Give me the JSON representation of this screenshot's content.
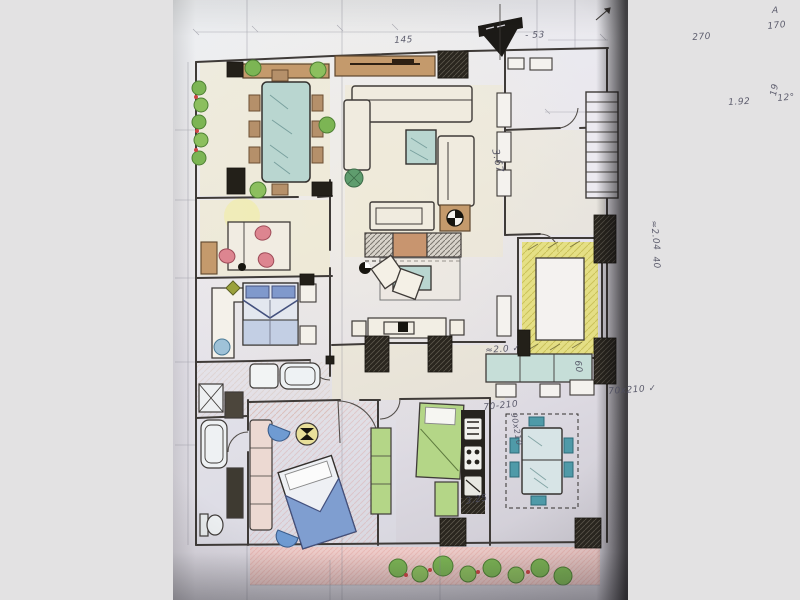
{
  "scene": {
    "kind": "photograph of a hand-drawn, colored-pencil apartment floor plan",
    "background_color": "#e3e2e3",
    "paper_color": "#e9e6ec",
    "photo_edge_shadow": "#141316"
  },
  "palette": {
    "pencil_line": "#3f3b38",
    "handwriting": "#4e4e60",
    "wood_brown": "#c49a6c",
    "glass_teal": "#b9d6d0",
    "plant_green": "#7cb554",
    "flower_red": "#cc4444",
    "chair_pink": "#dd8590",
    "bed_blue": "#8099cc",
    "wall_yellow": "#e5de6d",
    "kitchen_green": "#b4d687",
    "terrace_pink": "#f3c9c4",
    "poche_black": "#232019",
    "cream_floor": "#f0e9c8"
  },
  "rooms": [
    "dining",
    "living",
    "study",
    "master-bedroom",
    "en-suite-bath",
    "bathroom",
    "second-bedroom",
    "kitchen",
    "breakfast-corner",
    "hall",
    "entry",
    "elevator-core",
    "staircase",
    "terrace"
  ],
  "compass": {
    "symbol": "north-arrow",
    "position": "top-center"
  },
  "annotations": [
    {
      "id": 1,
      "text": "145",
      "x": 394,
      "y": 36,
      "rot": -3
    },
    {
      "id": 2,
      "text": "- 53",
      "x": 525,
      "y": 31,
      "rot": -2
    },
    {
      "id": 3,
      "text": "270",
      "x": 692,
      "y": 33,
      "rot": -4
    },
    {
      "id": 4,
      "text": "170",
      "x": 767,
      "y": 22,
      "rot": -6
    },
    {
      "id": 5,
      "text": "A",
      "x": 772,
      "y": 6,
      "rot": 0
    },
    {
      "id": 6,
      "text": "19",
      "x": 769,
      "y": 95,
      "rot": -80
    },
    {
      "id": 7,
      "text": "1.92",
      "x": 728,
      "y": 98,
      "rot": -3
    },
    {
      "id": 8,
      "text": "12°",
      "x": 777,
      "y": 94,
      "rot": -5
    },
    {
      "id": 9,
      "text": "3.67",
      "x": 500,
      "y": 148,
      "rot": 78,
      "size": 10
    },
    {
      "id": 10,
      "text": "≈2.04",
      "x": 658,
      "y": 220,
      "rot": 84
    },
    {
      "id": 11,
      "text": "40",
      "x": 660,
      "y": 256,
      "rot": 84
    },
    {
      "id": 12,
      "text": "≈2.0 ✓",
      "x": 485,
      "y": 346,
      "rot": -4
    },
    {
      "id": 13,
      "text": "60",
      "x": 582,
      "y": 360,
      "rot": 84
    },
    {
      "id": 14,
      "text": "70-210",
      "x": 483,
      "y": 403,
      "rot": -6
    },
    {
      "id": 15,
      "text": "90x210",
      "x": 518,
      "y": 412,
      "rot": 80,
      "size": 8
    },
    {
      "id": 16,
      "text": "70x210 ✓",
      "x": 608,
      "y": 387,
      "rot": -4
    },
    {
      "id": 17,
      "text": "3.25",
      "x": 465,
      "y": 497,
      "rot": -10
    }
  ]
}
